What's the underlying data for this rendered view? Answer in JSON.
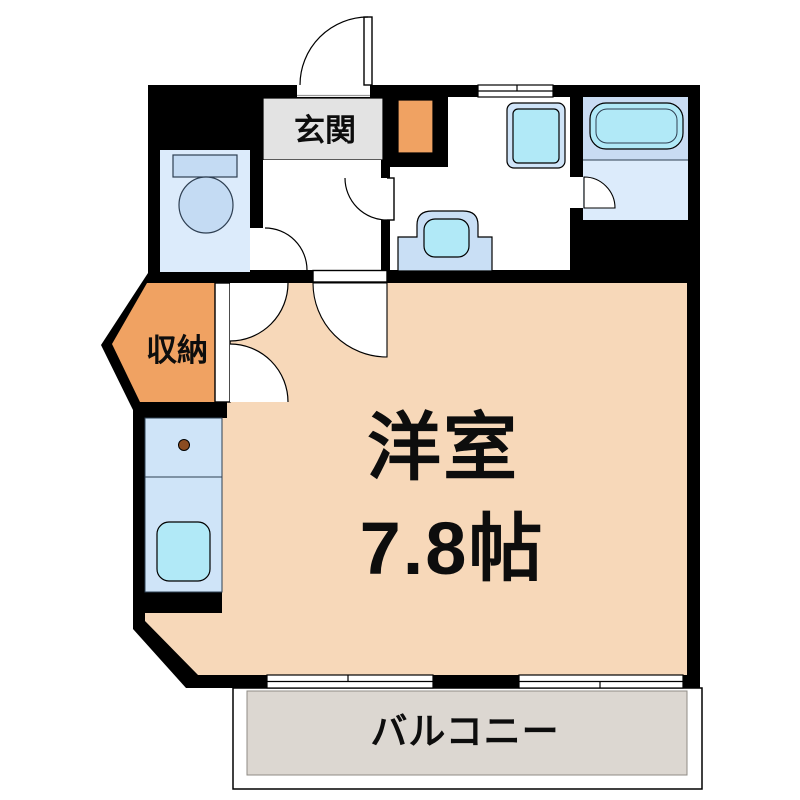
{
  "labels": {
    "genkan": "玄関",
    "storage": "収納",
    "main_room_name": "洋室",
    "main_room_size": "7.8帖",
    "balcony": "バルコニー"
  },
  "colors": {
    "wall": "#000000",
    "room-peach": "#f7d8b9",
    "storage-orange": "#f0a262",
    "genkan-gray": "#e3e3e3",
    "balcony-gray": "#dcd7d1",
    "balcony-border": "#8f8b85",
    "floor-pale-blue": "#dcebfb",
    "tub-surround-blue": "#c9dcf3",
    "fixture-blue": "#c4dbf3",
    "cabinet-blue": "#cfe4f8",
    "counter-blue": "#c9dff5",
    "cyan": "#b1e9f7",
    "knob-brown": "#8b4c21",
    "outline-dark": "#2e3f52"
  }
}
